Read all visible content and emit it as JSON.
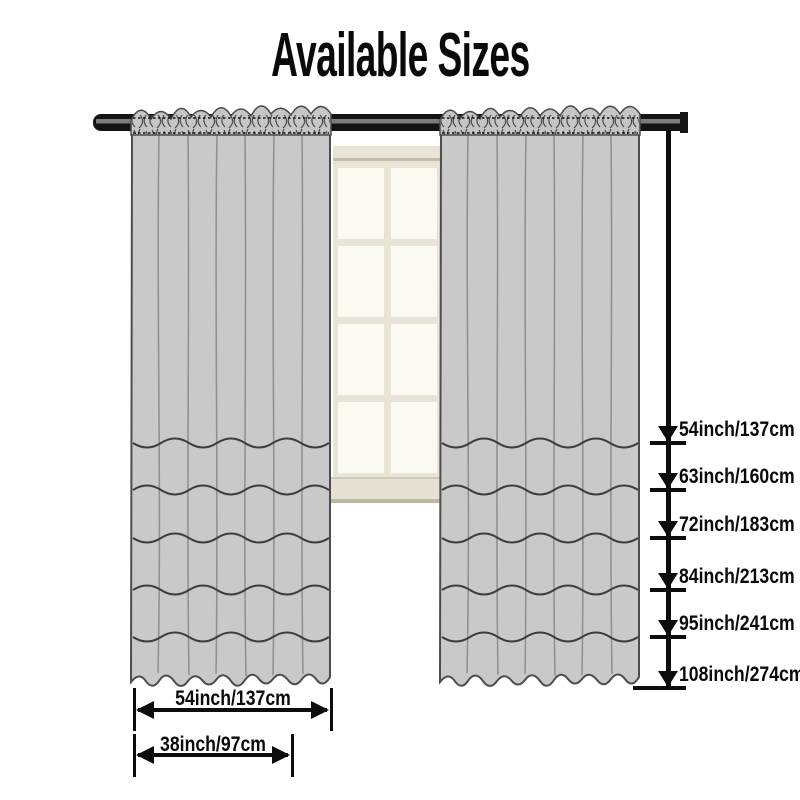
{
  "title": "Available Sizes",
  "measurements": {
    "line_x": 668,
    "line_top": 131,
    "heights": [
      {
        "label": "54inch/137cm",
        "y": 443,
        "bar_x": 650,
        "bar_w": 36
      },
      {
        "label": "63inch/160cm",
        "y": 490,
        "bar_x": 650,
        "bar_w": 36
      },
      {
        "label": "72inch/183cm",
        "y": 538,
        "bar_x": 650,
        "bar_w": 36
      },
      {
        "label": "84inch/213cm",
        "y": 590,
        "bar_x": 650,
        "bar_w": 36
      },
      {
        "label": "95inch/241cm",
        "y": 637,
        "bar_x": 650,
        "bar_w": 36
      },
      {
        "label": "108inch/274cm",
        "y": 688,
        "bar_x": 633,
        "bar_w": 53
      }
    ],
    "widths": [
      {
        "label": "54inch/137cm",
        "x1": 134,
        "x2": 331,
        "bar_top": 688,
        "bar_height": 43,
        "arrow_y": 710,
        "label_y": 688
      },
      {
        "label": "38inch/97cm",
        "x1": 134,
        "x2": 292,
        "bar_top": 734,
        "bar_height": 43,
        "arrow_y": 755,
        "label_y": 734
      }
    ]
  },
  "colors": {
    "text": "#0a0a0a",
    "measure_line": "#0c0c0c",
    "curtain_fill": "#c9c9c9",
    "curtain_outline": "#4d4d4d",
    "rod": "#141414",
    "rod_highlight": "#7d7d7d",
    "window_frame": "#e8e4d6",
    "window_pane": "#fbfaf2",
    "window_sill": "#e6e2d3"
  }
}
